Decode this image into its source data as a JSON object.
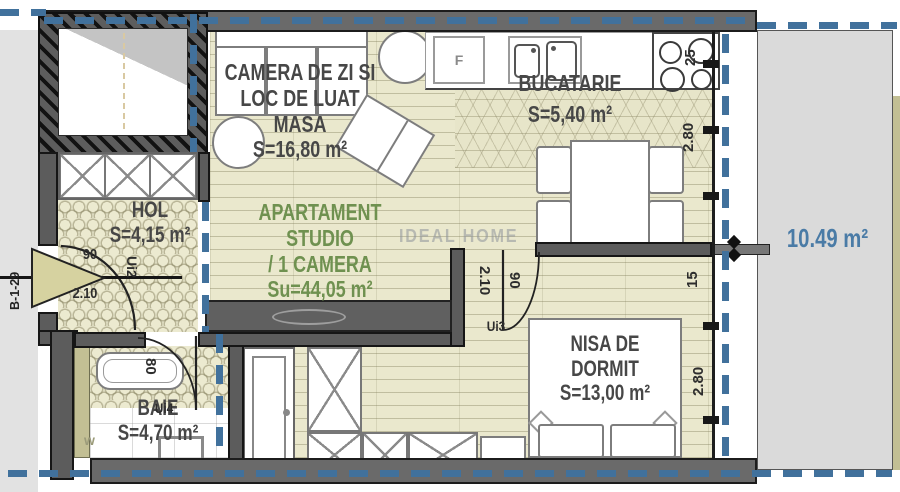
{
  "watermark": "IDEAL HOME",
  "unit_code": "B-1-29",
  "rooms": {
    "living": {
      "line1": "CAMERA DE ZI SI",
      "line2": "LOC DE LUAT MASA",
      "area": "S=16,80 m²"
    },
    "kitchen": {
      "name": "BUCATARIE",
      "area": "S=5,40 m²"
    },
    "hall": {
      "name": "HOL",
      "area": "S=4,15 m²"
    },
    "studio": {
      "line1": "APARTAMENT STUDIO",
      "line2": "/ 1 CAMERA",
      "area": "Su=44,05 m²"
    },
    "sleeping": {
      "line1": "NISA DE",
      "line2": "DORMIT",
      "area": "S=13,00 m²"
    },
    "bath": {
      "name": "BAIE",
      "area": "S=4,70 m²"
    },
    "terrace": {
      "area": "10.49 m²"
    }
  },
  "doors": {
    "entrance": {
      "label": "Ui2",
      "width": "90",
      "height": "2.10"
    },
    "interior": {
      "label": "Ui3",
      "width": "90",
      "height": "2.10"
    },
    "bath": {
      "label": "Ui4",
      "width": "80"
    }
  },
  "dimensions": {
    "counter_depth": "25",
    "kitchen_width": "2.80",
    "wall_offset": "15",
    "sleeping_width": "2.80"
  },
  "appliances": {
    "fridge": "F",
    "washer": "w"
  },
  "colors": {
    "floor": "#eae8cd",
    "wall": "#5c5c5c",
    "window_dash": "#41719c",
    "studio_text": "#6f9150",
    "terrace_text": "#4a7ba6",
    "terrace_fill": "#dadada"
  }
}
